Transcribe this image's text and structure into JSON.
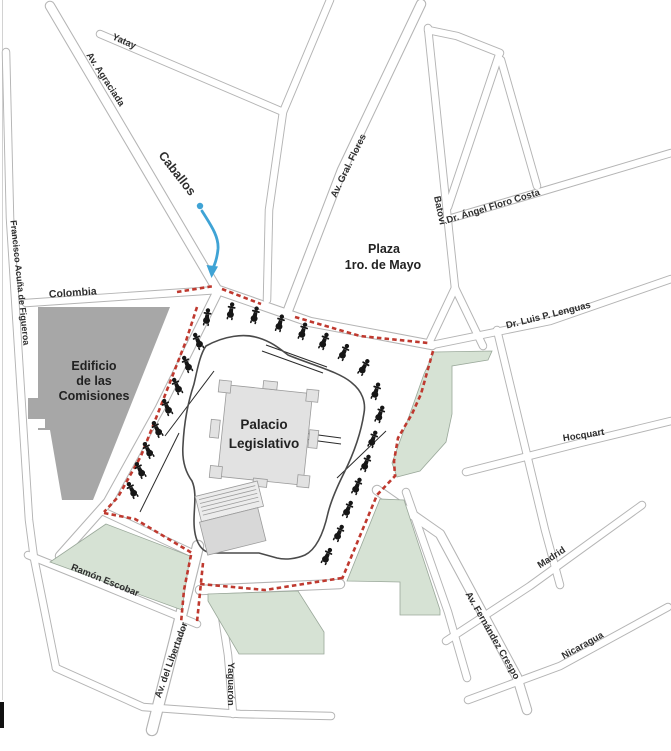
{
  "map": {
    "description": "Street map of the Palacio Legislativo area with a red dashed security perimeter, mounted-guard icons and a blue access route arrow",
    "colors": {
      "street_casing": "#b4b4b4",
      "green_area": "#d6e2d4",
      "green_stroke": "#9aa89a",
      "building_dark": "#a7a7a7",
      "building_light": "#e2e2e2",
      "plaza_ring": "#4a4a4a",
      "perimeter_red": "#bf392f",
      "route_blue": "#3fa3d5",
      "label": "#2e2e2e",
      "icon": "#161616"
    },
    "street_labels": [
      {
        "id": "yatay",
        "text": "Yatay",
        "x": 123,
        "y": 44,
        "rot": 24,
        "size": 9.5
      },
      {
        "id": "agraciada",
        "text": "Av. Agraciada",
        "x": 103,
        "y": 81,
        "rot": 57,
        "size": 9.5
      },
      {
        "id": "caballos",
        "text": "Caballos",
        "x": 174,
        "y": 176,
        "rot": 52,
        "size": 12.5
      },
      {
        "id": "gral-flores",
        "text": "Av. Gral. Flores",
        "x": 351,
        "y": 167,
        "rot": -64,
        "size": 9.5
      },
      {
        "id": "batovi",
        "text": "Batoví",
        "x": 437,
        "y": 211,
        "rot": 78,
        "size": 9.5
      },
      {
        "id": "floro-costa",
        "text": "Dr. Ángel Floro Costa",
        "x": 494,
        "y": 209,
        "rot": -17,
        "size": 9.5
      },
      {
        "id": "colombia",
        "text": "Colombia",
        "x": 73,
        "y": 296,
        "rot": -4,
        "size": 10.5
      },
      {
        "id": "figueroa",
        "text": "Francisco Acuña de Figueroa",
        "x": 17,
        "y": 283,
        "rot": 84,
        "size": 9
      },
      {
        "id": "lenguas",
        "text": "Dr. Luis P. Lenguas",
        "x": 549,
        "y": 318,
        "rot": -14,
        "size": 9.5
      },
      {
        "id": "hocquart",
        "text": "Hocquart",
        "x": 584,
        "y": 438,
        "rot": -9,
        "size": 9.5
      },
      {
        "id": "madrid",
        "text": "Madrid",
        "x": 553,
        "y": 560,
        "rot": -33,
        "size": 9.5
      },
      {
        "id": "fernandez-crespo",
        "text": "Av. Fernández Crespo",
        "x": 490,
        "y": 637,
        "rot": 60,
        "size": 9.5
      },
      {
        "id": "nicaragua",
        "text": "Nicaragua",
        "x": 584,
        "y": 648,
        "rot": -29,
        "size": 9.5
      },
      {
        "id": "ramon-escobar",
        "text": "Ramón Escobar",
        "x": 104,
        "y": 583,
        "rot": 22,
        "size": 9.5
      },
      {
        "id": "libertador",
        "text": "Av. del Libertador",
        "x": 174,
        "y": 661,
        "rot": -70,
        "size": 9.5
      },
      {
        "id": "yaguaron",
        "text": "Yaguarón",
        "x": 228,
        "y": 684,
        "rot": 90,
        "size": 9.5
      }
    ],
    "area_labels": [
      {
        "id": "plaza-1ro-de-mayo",
        "size": 12.5,
        "weight": "bold",
        "lines": [
          {
            "text": "Plaza",
            "x": 384,
            "y": 253
          },
          {
            "text": "1ro. de Mayo",
            "x": 383,
            "y": 269
          }
        ]
      },
      {
        "id": "edificio-comisiones",
        "size": 12.5,
        "weight": "600",
        "lines": [
          {
            "text": "Edificio",
            "x": 94,
            "y": 370
          },
          {
            "text": "de las",
            "x": 94,
            "y": 385
          },
          {
            "text": "Comisiones",
            "x": 94,
            "y": 400
          }
        ]
      },
      {
        "id": "palacio-legislativo",
        "size": 13.5,
        "weight": "600",
        "lines": [
          {
            "text": "Palacio",
            "x": 264,
            "y": 429
          },
          {
            "text": "Legislativo",
            "x": 264,
            "y": 448
          }
        ]
      }
    ],
    "rider_icons": {
      "name": "mounted-guard-icon",
      "positions": [
        [
          198,
          341,
          -25
        ],
        [
          187,
          364,
          -25
        ],
        [
          177,
          386,
          -25
        ],
        [
          167,
          407,
          -25
        ],
        [
          157,
          429,
          -28
        ],
        [
          148,
          450,
          -28
        ],
        [
          140,
          470,
          -28
        ],
        [
          132,
          490,
          -28
        ],
        [
          207,
          317,
          8
        ],
        [
          231,
          311,
          10
        ],
        [
          255,
          315,
          14
        ],
        [
          280,
          323,
          16
        ],
        [
          303,
          331,
          18
        ],
        [
          324,
          341,
          22
        ],
        [
          344,
          352,
          26
        ],
        [
          364,
          367,
          30
        ],
        [
          376,
          391,
          18
        ],
        [
          380,
          414,
          20
        ],
        [
          373,
          439,
          20
        ],
        [
          366,
          463,
          22
        ],
        [
          357,
          486,
          22
        ],
        [
          348,
          509,
          24
        ],
        [
          339,
          533,
          24
        ],
        [
          327,
          556,
          26
        ]
      ]
    }
  }
}
